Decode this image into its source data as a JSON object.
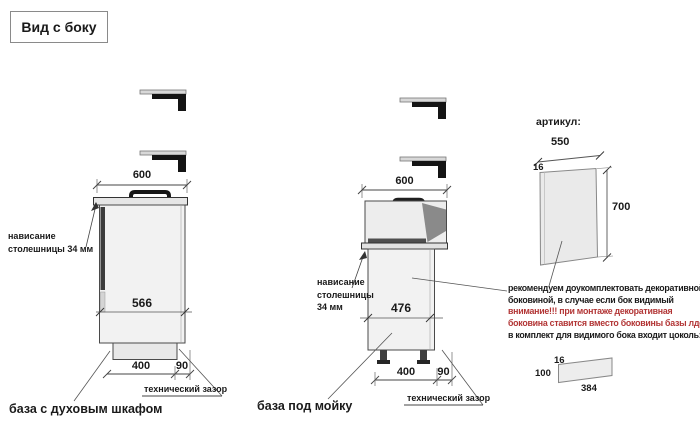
{
  "title": "Вид с боку",
  "left_cabinet": {
    "label": "база с духовым шкафом",
    "dim_top_width": "600",
    "dim_inner": "566",
    "dim_bottom_main": "400",
    "dim_bottom_gap": "90",
    "overhang_line1": "нависание",
    "overhang_line2": "столешницы 34 мм",
    "tech_gap_label": "технический зазор"
  },
  "sink_cabinet": {
    "label": "база под мойку",
    "dim_top_width": "600",
    "dim_inner": "476",
    "dim_bottom_main": "400",
    "dim_bottom_gap": "90",
    "overhang_line1": "нависание",
    "overhang_line2": "столешницы",
    "overhang_line3": "34 мм",
    "tech_gap_label": "технический зазор"
  },
  "side_panel": {
    "articul_label": "артикул:",
    "dim_width": "550",
    "dim_thickness": "16",
    "dim_height": "700",
    "note_line1": "рекомендуем доукомплектовать декоративной",
    "note_line2": "боковиной, в случае если бок видимый",
    "note_line3": "внимание!!! при монтаже декоративная",
    "note_line4": "боковина ставится вместо боковины базы лдсп",
    "note_line5": "в комплект для видимого бока входит цоколь:"
  },
  "plinth_part": {
    "dim_thickness": "16",
    "dim_height": "100",
    "dim_length": "384"
  },
  "colors": {
    "warning_text": "#b23535",
    "drawing_line": "#444444",
    "cabinet_fill": "#f2f2f2",
    "oven_door_strip": "#3c3c3c",
    "sink_shadow": "#8a8a8a"
  },
  "icons": {
    "bracket": "mounting-bracket-icon"
  }
}
